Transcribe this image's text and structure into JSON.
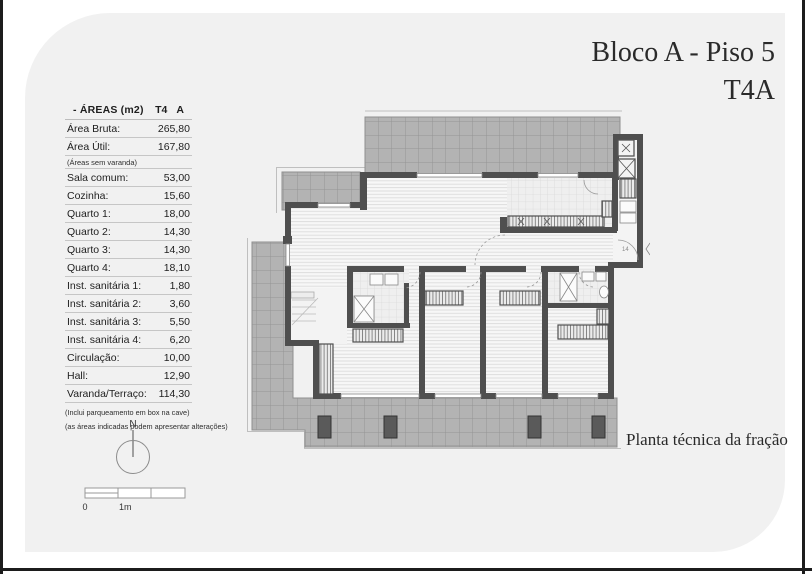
{
  "document": {
    "title_block": "Bloco A - Piso 5",
    "title_fraction": "T4A",
    "caption": "Planta técnica da fração"
  },
  "areas_table": {
    "header": {
      "title": "- ÁREAS (m2)",
      "typology": "T4",
      "fraction": "A"
    },
    "rows": [
      {
        "label": "Área Bruta:",
        "value": "265,80"
      },
      {
        "label": "Área Útil:",
        "value": "167,80"
      },
      {
        "label": "(Áreas sem varanda)",
        "value": ""
      },
      {
        "label": "Sala comum:",
        "value": "53,00"
      },
      {
        "label": "Cozinha:",
        "value": "15,60"
      },
      {
        "label": "Quarto 1:",
        "value": "18,00"
      },
      {
        "label": "Quarto 2:",
        "value": "14,30"
      },
      {
        "label": "Quarto 3:",
        "value": "14,30"
      },
      {
        "label": "Quarto 4:",
        "value": "18,10"
      },
      {
        "label": "Inst. sanitária 1:",
        "value": "1,80"
      },
      {
        "label": "Inst. sanitária 2:",
        "value": "3,60"
      },
      {
        "label": "Inst. sanitária 3:",
        "value": "5,50"
      },
      {
        "label": "Inst. sanitária 4:",
        "value": "6,20"
      },
      {
        "label": "Circulação:",
        "value": "10,00"
      },
      {
        "label": "Hall:",
        "value": "12,90"
      },
      {
        "label": "Varanda/Terraço:",
        "value": "114,30"
      }
    ],
    "footnotes": [
      "(Inclui parqueamento em box na cave)",
      "(as áreas indicadas podem apresentar alterações)"
    ]
  },
  "compass": {
    "north_label": "N"
  },
  "scale_bar": {
    "start_label": "0",
    "unit_label": "1m"
  },
  "floorplan": {
    "entrance_label": "14"
  },
  "colors": {
    "page_background": "#f1f1f1",
    "frame_line": "#1c1c1c",
    "wall": "#4f4f4f",
    "terrace_tile": "#b3b3b3",
    "room_floor": "#f7f7f7"
  }
}
